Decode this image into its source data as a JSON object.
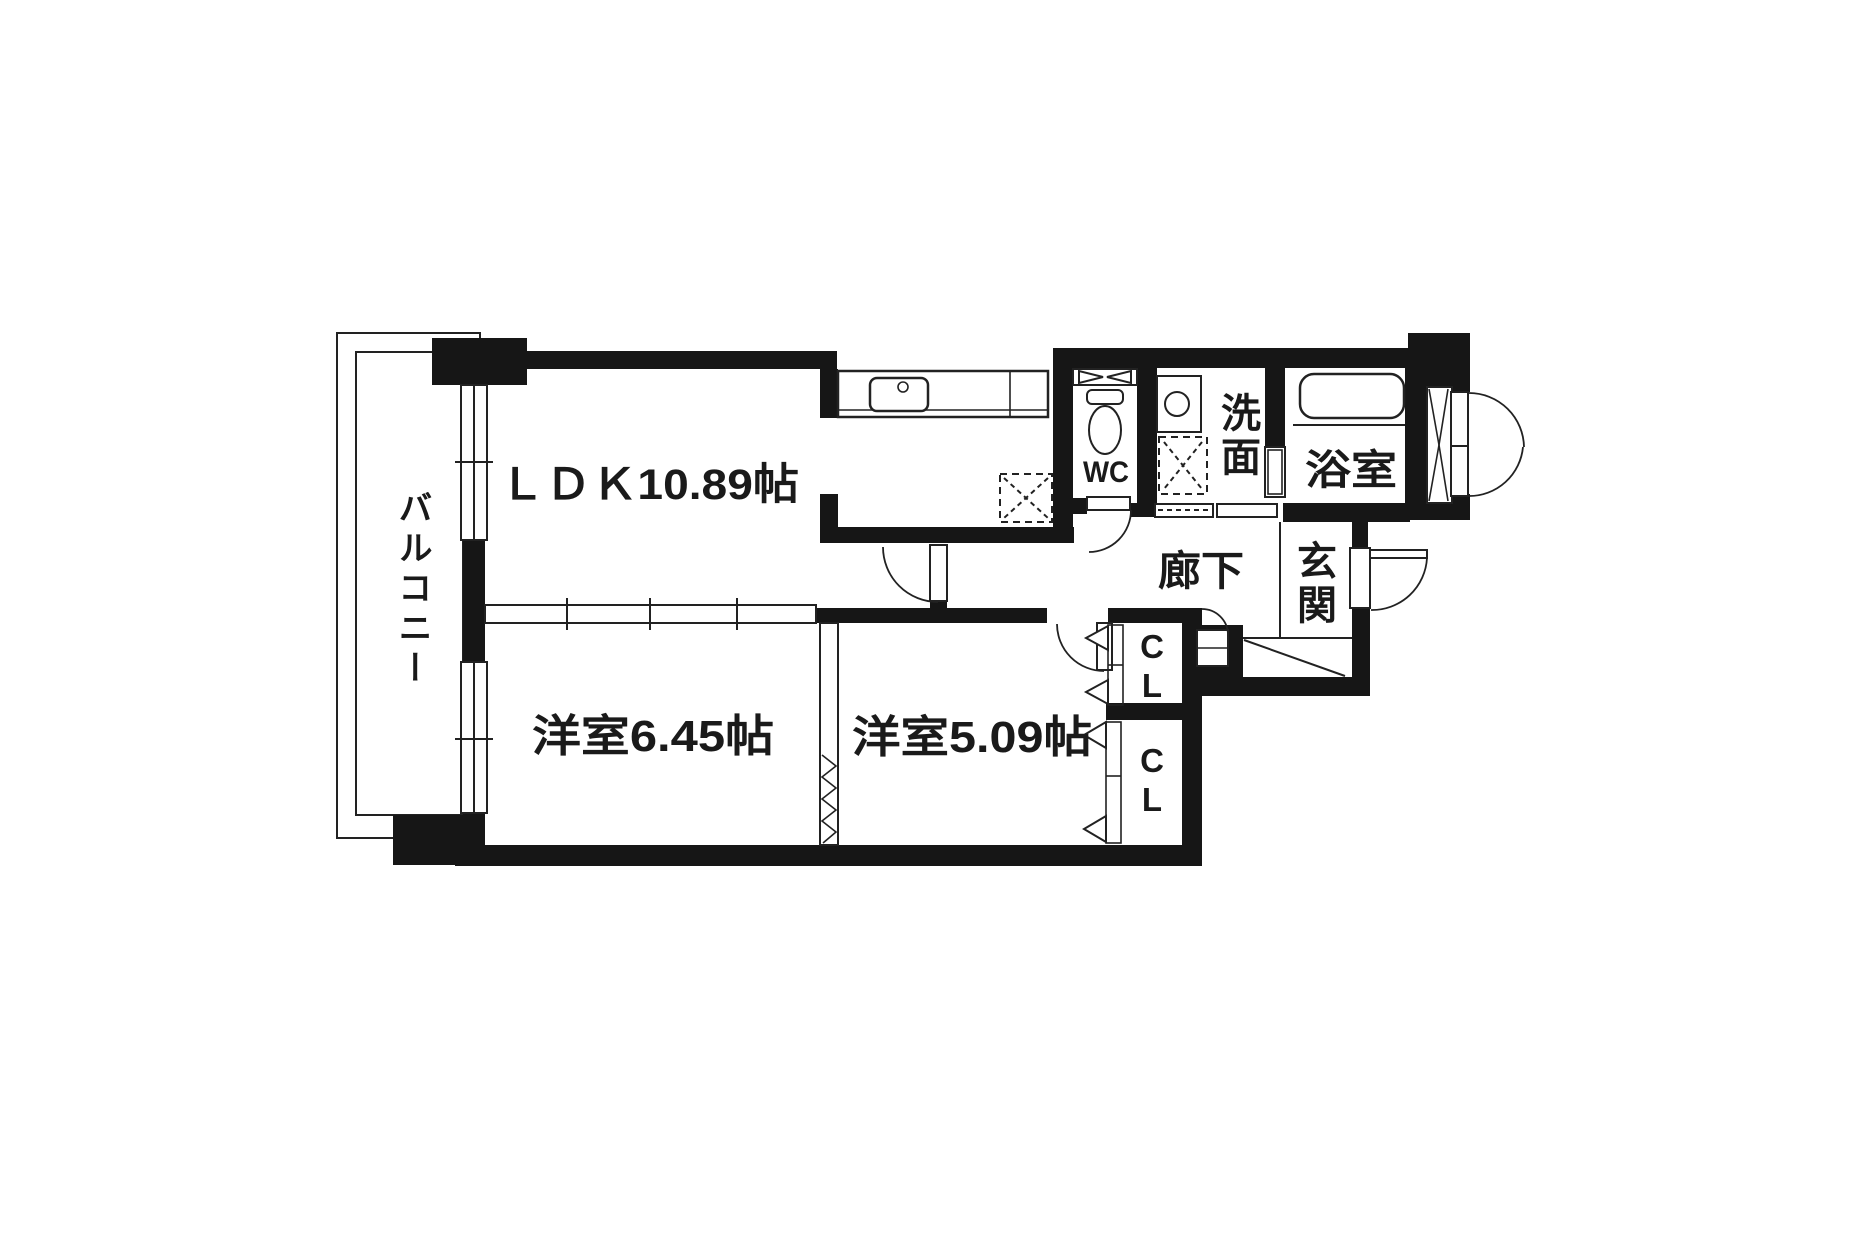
{
  "labels": {
    "balcony": "バルコニー",
    "ldk": "ＬＤＫ10.89帖",
    "bedroom1": "洋室6.45帖",
    "bedroom2": "洋室5.09帖",
    "wc": "WC",
    "washroom": "洗面",
    "bathroom": "浴室",
    "hallway": "廊下",
    "entrance": "玄関",
    "closet_top": "CL",
    "closet_bottom": "CL"
  },
  "colors": {
    "wall": "#161616",
    "line": "#222222",
    "ink": "#1a1a1a",
    "background": "#ffffff"
  }
}
